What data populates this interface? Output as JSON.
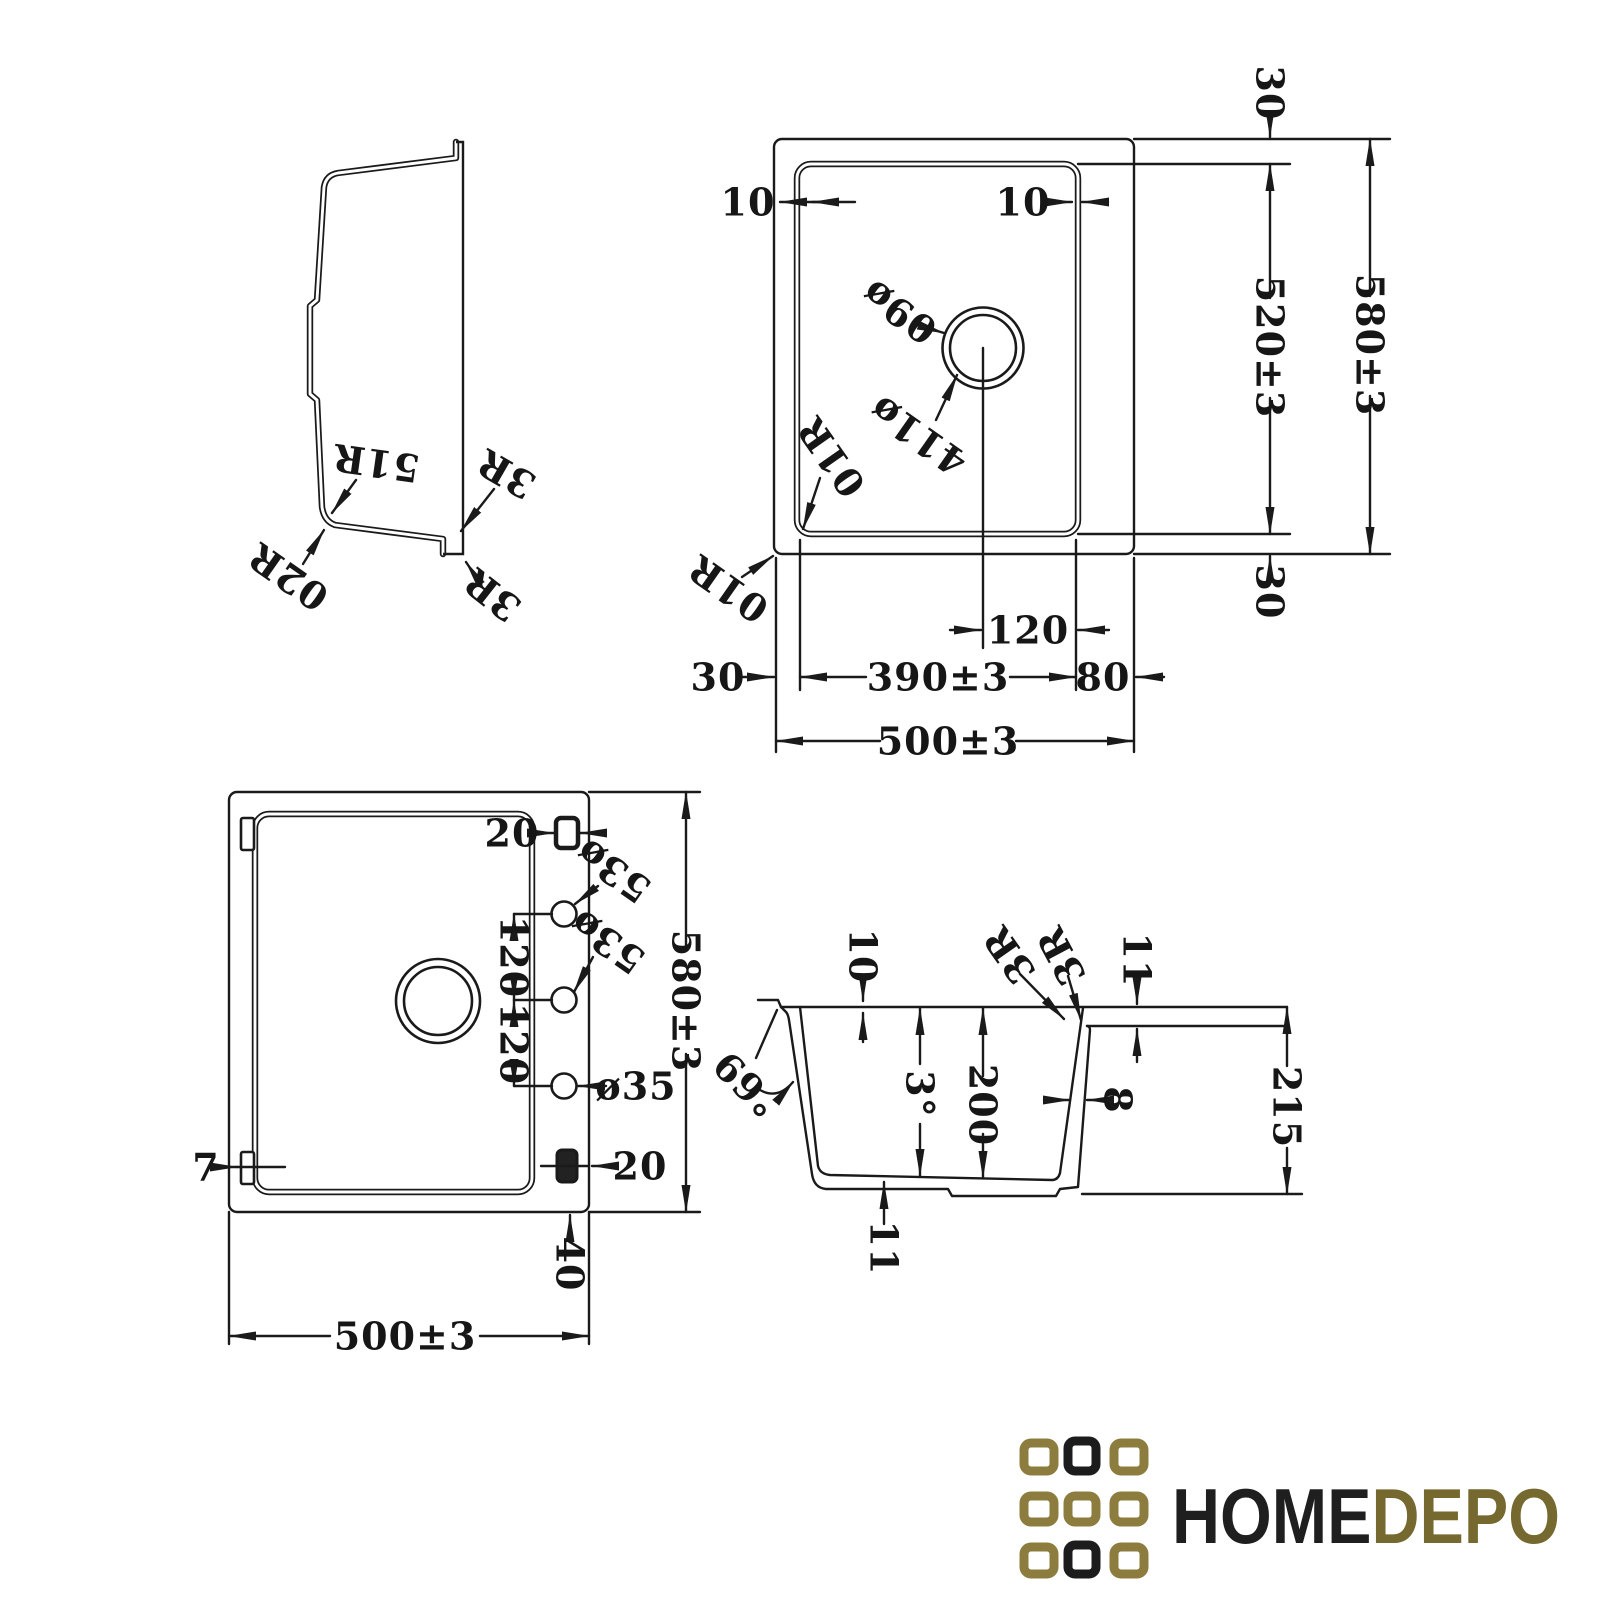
{
  "drawing": {
    "line_color": "#1a1a1a",
    "views": {
      "side_profile": {
        "labels": {
          "r15": "R15",
          "r20": "R20",
          "r3_top": "R3",
          "r3_bottom": "R3"
        }
      },
      "top_view": {
        "labels": {
          "edge_left": "10",
          "edge_right": "10",
          "drain_hole_dia": "ø90",
          "drain_flange_dia": "ø114",
          "corner_inner": "R10",
          "corner_outer": "R10",
          "margin_top": "30",
          "inner_height": "520±3",
          "outer_height": "580±3",
          "margin_bottom": "30",
          "drain_offset": "120",
          "margin_left": "30",
          "inner_width": "390±3",
          "deck_width": "80",
          "outer_width": "500±3"
        }
      },
      "bottom_view": {
        "labels": {
          "slot_top": "20",
          "tap_hole_1": "ø35",
          "tap_hole_2": "ø35",
          "tap_hole_3": "ø35",
          "hole_pitch_1": "120",
          "hole_pitch_2": "120",
          "outer_height": "580±3",
          "flange_thickness": "7",
          "slot_bottom": "20",
          "slot_offset": "40",
          "outer_width": "500±3"
        }
      },
      "section_view": {
        "labels": {
          "rim_lip_height": "10",
          "radius_a": "R3",
          "radius_b": "R3",
          "rim_thickness": "11",
          "outer_wall_angle": "96°",
          "bottom_slope": "3°",
          "bowl_depth": "200",
          "wall_thickness": "8",
          "overall_depth": "215",
          "bottom_thickness": "11"
        }
      }
    }
  },
  "logo": {
    "text_primary": "HOME",
    "text_secondary": "DEPO",
    "colors": {
      "gold": "#8c7c3e",
      "dark": "#1c1c1c",
      "text_dark": "#1f1f1f",
      "text_gold": "#75692f"
    },
    "grid_fills": [
      "#8c7c3e",
      "#1c1c1c",
      "#8c7c3e",
      "#8c7c3e",
      "#8c7c3e",
      "#8c7c3e",
      "#8c7c3e",
      "#1c1c1c",
      "#8c7c3e"
    ]
  }
}
